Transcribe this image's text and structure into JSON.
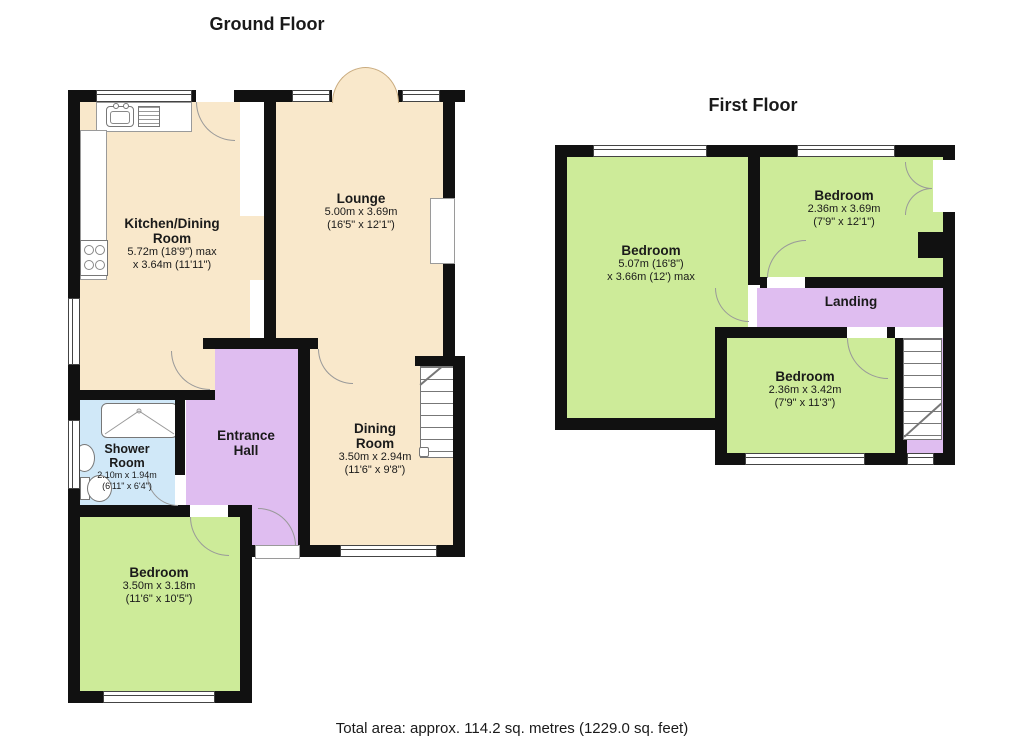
{
  "colors": {
    "wall": "#111111",
    "cream": "#f9e8cb",
    "green": "#cdeb99",
    "purple": "#dfbdf0",
    "blue": "#d0e8f8",
    "arc": "#999999"
  },
  "ground": {
    "title": "Ground Floor",
    "rooms": [
      {
        "id": "kitchen",
        "name": "Kitchen/Dining\nRoom",
        "dims": "5.72m (18'9\") max\nx 3.64m (11'11\")"
      },
      {
        "id": "lounge",
        "name": "Lounge",
        "dims": "5.00m x 3.69m\n(16'5\" x 12'1\")"
      },
      {
        "id": "dining",
        "name": "Dining\nRoom",
        "dims": "3.50m x 2.94m\n(11'6\" x 9'8\")"
      },
      {
        "id": "entrance-hall",
        "name": "Entrance\nHall",
        "dims": ""
      },
      {
        "id": "shower-room",
        "name": "Shower\nRoom",
        "dims": "2.10m x 1.94m\n(6'11\" x 6'4\")"
      },
      {
        "id": "bedroom",
        "name": "Bedroom",
        "dims": "3.50m x 3.18m\n(11'6\" x 10'5\")"
      }
    ]
  },
  "first": {
    "title": "First Floor",
    "rooms": [
      {
        "id": "bedroom-1",
        "name": "Bedroom",
        "dims": "5.07m (16'8\")\nx 3.66m (12') max"
      },
      {
        "id": "bedroom-2",
        "name": "Bedroom",
        "dims": "2.36m x 3.69m\n(7'9\" x 12'1\")"
      },
      {
        "id": "landing",
        "name": "Landing",
        "dims": ""
      },
      {
        "id": "bedroom-3",
        "name": "Bedroom",
        "dims": "2.36m x 3.42m\n(7'9\" x 11'3\")"
      }
    ]
  },
  "footer": {
    "total_area": "Total area: approx. 114.2 sq. metres (1229.0 sq. feet)"
  }
}
